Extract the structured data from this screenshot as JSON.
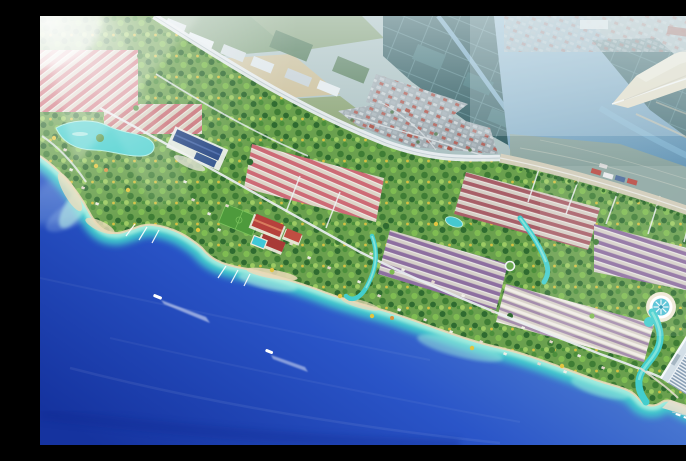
{
  "scene": {
    "kind": "aerial-architectural-rendering",
    "aria_label": "Aerial perspective rendering of a seaside township masterplan: rows of pink and purple roofed villas among dense green trees, turquoise lagoons and canals, a red-roofed clubhouse with sports field, a circular fountain pool, a white high-rise beachfront hotel, boats with wakes on a deep blue sea, and beyond a highway an existing town, farm fields, dark aquaculture ponds, a river estuary and a pale sand spit, lit by sun flare from the top left",
    "features": {
      "offshore_boats": 2,
      "moored_boats": 3,
      "piers": 6,
      "villa_row_blocks": 7,
      "lagoons": 3,
      "landmarks": [
        "clubhouse",
        "sports-field",
        "blue-roof-community-building",
        "circular-fountain-pool",
        "hotel-tower",
        "roundabout",
        "sand-spit",
        "river-estuary",
        "aquaculture-ponds",
        "existing-town",
        "highway"
      ]
    },
    "colors": {
      "sea_deep": "#15339f",
      "sea_mid": "#2a55c8",
      "sea_light": "#5d8ed6",
      "shore_turquoise": "#43cecd",
      "shore_pale": "#abf0e0",
      "sand": "#ead9b8",
      "land_green": "#6aa04e",
      "tree_dark": "#2f6b30",
      "tree_mid": "#4c8f3c",
      "tree_mid2": "#3f7d35",
      "tree_light": "#7fbc52",
      "tree_light2": "#9ccb63",
      "tree_yellow": "#e2c540",
      "roof_pink": "#cd6b76",
      "roof_red": "#b6413c",
      "roof_purple": "#8d6fa0",
      "roof_wine": "#a85f68",
      "roof_blue": "#2c4b86",
      "road_white": "#e9eef1",
      "road_tan": "#d8d2c0",
      "pond_dark": "#2b575d",
      "river_light": "#8fb6ce",
      "river_mid": "#5f91b2",
      "town_grey": "#9aa5ab",
      "field_green": "#6a8f63",
      "field_green2": "#87a06e",
      "field_tan": "#c9b98e",
      "hotel_white": "#eef3f7",
      "hotel_stripe": "#7e96ad",
      "hotel_base": "#b9705f",
      "spit_sand": "#e6dcc2",
      "haze": "#e3f0f3"
    }
  }
}
